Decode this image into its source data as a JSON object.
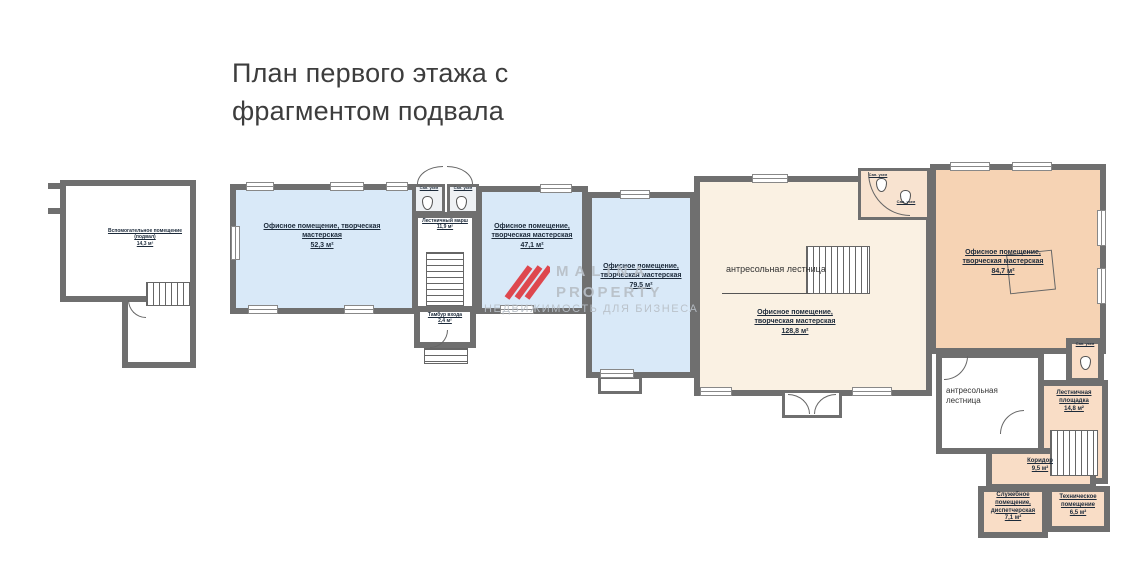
{
  "title": "План первого этажа с фрагментом подвала",
  "watermark": {
    "line1": "MALINA",
    "line2": "PROPERTY",
    "tagline": "НЕДВИЖИМОСТЬ ДЛЯ БИЗНЕСА",
    "logo_color": "#df3a40",
    "text_color": "#b8bfc7"
  },
  "colors": {
    "wall": "#6f6f6f",
    "office_blue": "#d9e9f8",
    "office_cream": "#faf1e3",
    "office_peach": "#f6d3b4",
    "wing_peach": "#f9ddc6",
    "label_text": "#1c2a3a"
  },
  "rooms": [
    {
      "id": "basement",
      "name": "Вспомогательное помещение (подвал)",
      "area": "14,3 м²"
    },
    {
      "id": "office-1",
      "name": "Офисное помещение, творческая мастерская",
      "area": "52,3 м²"
    },
    {
      "id": "stair-flight",
      "name": "Лестничный марш",
      "area": "11,9 м²"
    },
    {
      "id": "tambour",
      "name": "Тамбур входа",
      "area": "2,4 м²"
    },
    {
      "id": "office-2",
      "name": "Офисное помещение, творческая мастерская",
      "area": "47,1 м²"
    },
    {
      "id": "office-3",
      "name": "Офисное помещение, творческая мастерская",
      "area": "79,5 м²"
    },
    {
      "id": "office-4",
      "name": "Офисное помещение, творческая мастерская",
      "area": "128,8 м²"
    },
    {
      "id": "office-5",
      "name": "Офисное помещение, творческая мастерская",
      "area": "84,7 м²"
    },
    {
      "id": "stair-landing",
      "name": "Лестничная площадка",
      "area": "14,8 м²"
    },
    {
      "id": "corridor",
      "name": "Коридор",
      "area": "9,5 м²"
    },
    {
      "id": "service",
      "name": "Служебное помещение, диспетчерская",
      "area": "7,1 м²"
    },
    {
      "id": "technical",
      "name": "Техническое помещение",
      "area": "6,5 м²"
    }
  ],
  "annotations": {
    "mezzanine_left": "антресольная лестница",
    "mezzanine_right": "антресольная лестница"
  },
  "labels": {
    "wc": "Сан. узел"
  }
}
